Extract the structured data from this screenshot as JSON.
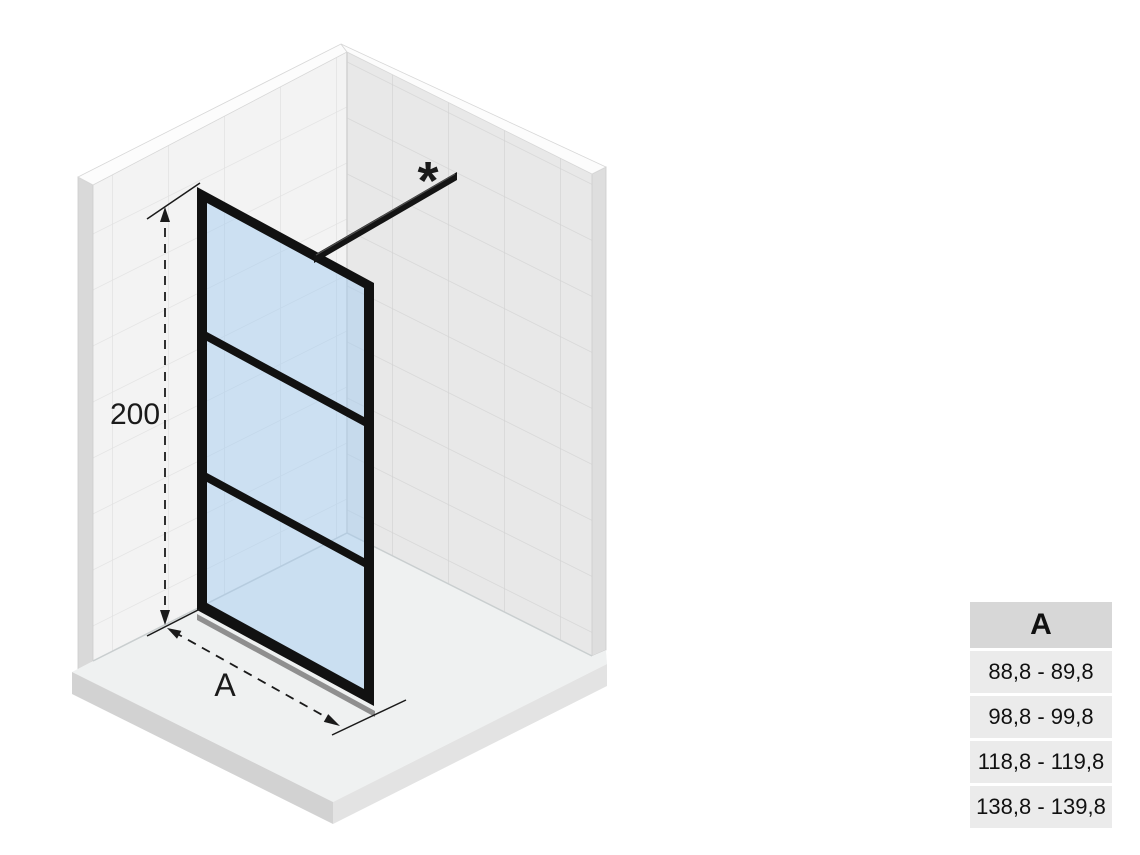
{
  "diagram": {
    "height_dimension": "200",
    "width_dimension": "A",
    "footnote_marker": "*"
  },
  "size_table": {
    "header": "A",
    "rows": [
      "88,8 - 89,8",
      "98,8 - 99,8",
      "118,8 - 119,8",
      "138,8 - 139,8"
    ]
  },
  "colors": {
    "glass": "#c9dcec",
    "frame": "#111111",
    "wall_left": "#f3f3f3",
    "wall_right": "#e8e8e8",
    "floor_top": "#eff1f1",
    "table_header_bg": "#d7d7d7",
    "table_row_bg": "#ebebeb"
  }
}
